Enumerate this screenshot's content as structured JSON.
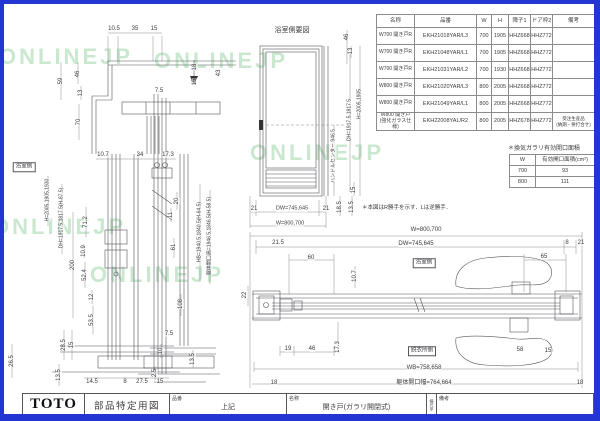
{
  "watermark_text": "ONLINEJP",
  "colors": {
    "frame": "#2336d4",
    "line": "#55565a",
    "dim": "#3c3c40",
    "watermark": "#96d2a0"
  },
  "watermarks": [
    {
      "x": -5,
      "y": 40
    },
    {
      "x": 150,
      "y": 44
    },
    {
      "x": -12,
      "y": 210
    },
    {
      "x": 86,
      "y": 258
    },
    {
      "x": 246,
      "y": 136
    }
  ],
  "parts_table": {
    "headers": [
      "名称",
      "品番",
      "W",
      "H",
      "障子1",
      "ドア枠2",
      "備考"
    ],
    "rows": [
      [
        "W700 開き戸R",
        "EKH21018YAR/L3",
        "700",
        "1905",
        "HHZ668",
        "HHZ772",
        ""
      ],
      [
        "W700 開き戸R",
        "EKH21048YAR/L1",
        "700",
        "1905",
        "HHZ668",
        "HHZ772",
        ""
      ],
      [
        "W700 開き戸R",
        "EKH21031YAR/L2",
        "700",
        "1930",
        "HHZ668",
        "HHZ772",
        ""
      ],
      [
        "W800 開き戸R",
        "EKH21020YAR/L3",
        "800",
        "2005",
        "HHZ668",
        "HHZ772",
        ""
      ],
      [
        "W800 開き戸R",
        "EKH21049YAR/L1",
        "800",
        "2005",
        "HHZ668",
        "HHZ772",
        ""
      ],
      [
        "W800 開き戸\n(強化ガラス仕様)",
        "EKH22008YAL/R2",
        "800",
        "2005",
        "HHZ678",
        "HHZ772",
        "受注生産品\n(納期・要打合せ)"
      ]
    ]
  },
  "vent_table": {
    "title": "＊換気ガラリ有効開口面積",
    "headers": [
      "W",
      "有効開口面積(cm²)"
    ],
    "rows": [
      [
        "700",
        "93"
      ],
      [
        "800",
        "111"
      ]
    ]
  },
  "note": "＊本図はR勝手を示す．Lは逆勝手．",
  "elevation_title": "浴室側要図",
  "boxed_labels": [
    {
      "t": "浴室側",
      "x": 20,
      "y": 163
    },
    {
      "t": "浴室側",
      "x": 420,
      "y": 259
    },
    {
      "t": "脱衣所側",
      "x": 418,
      "y": 347
    }
  ],
  "title_block": {
    "logo": "TOTO",
    "doc_type": "部品特定用図",
    "part_label": "品番",
    "part_value": "上記",
    "name_label": "名称",
    "name_value": "開き戸(ガラリ開閉式)",
    "scale_text": "縮尺非",
    "remarks_label": "備考"
  },
  "labels": [
    {
      "t": "10.5",
      "x": 110,
      "y": 25
    },
    {
      "t": "35",
      "x": 131,
      "y": 25
    },
    {
      "t": "15",
      "x": 150,
      "y": 25
    },
    {
      "t": "59",
      "x": 57,
      "y": 77,
      "v": 1
    },
    {
      "t": "46",
      "x": 74,
      "y": 70,
      "v": 1
    },
    {
      "t": "13",
      "x": 77,
      "y": 89,
      "v": 1
    },
    {
      "t": "70",
      "x": 75,
      "y": 118,
      "v": 1
    },
    {
      "t": "7.5",
      "x": 155,
      "y": 87
    },
    {
      "t": "18",
      "x": 191,
      "y": 63,
      "v": 1
    },
    {
      "t": "15",
      "x": 191,
      "y": 78,
      "v": 1
    },
    {
      "t": "43",
      "x": 215,
      "y": 69,
      "v": 1
    },
    {
      "t": "10.7",
      "x": 99,
      "y": 151
    },
    {
      "t": "34",
      "x": 136,
      "y": 151
    },
    {
      "t": "17.3",
      "x": 164,
      "y": 151
    },
    {
      "t": "200",
      "x": 69,
      "y": 261,
      "v": 1
    },
    {
      "t": "71.2",
      "x": 82,
      "y": 218,
      "v": 1
    },
    {
      "t": "10.9",
      "x": 80,
      "y": 247,
      "v": 1
    },
    {
      "t": "52.4",
      "x": 81,
      "y": 271,
      "v": 1
    },
    {
      "t": "12",
      "x": 88,
      "y": 293,
      "v": 1
    },
    {
      "t": "53.5",
      "x": 88,
      "y": 316,
      "v": 1
    },
    {
      "t": "28.5",
      "x": 60,
      "y": 341,
      "v": 1
    },
    {
      "t": "15",
      "x": 68,
      "y": 341,
      "v": 1
    },
    {
      "t": "13.5",
      "x": 55,
      "y": 371,
      "v": 1
    },
    {
      "t": "26.5",
      "x": 8,
      "y": 357,
      "v": 1
    },
    {
      "t": "14.5",
      "x": 88,
      "y": 378
    },
    {
      "t": "8",
      "x": 121,
      "y": 378
    },
    {
      "t": "27.5",
      "x": 138,
      "y": 378
    },
    {
      "t": "15",
      "x": 156,
      "y": 378
    },
    {
      "t": "20",
      "x": 173,
      "y": 197,
      "v": 1
    },
    {
      "t": "11",
      "x": 167,
      "y": 211,
      "v": 1
    },
    {
      "t": "61",
      "x": 170,
      "y": 243,
      "v": 1
    },
    {
      "t": "108",
      "x": 177,
      "y": 300,
      "v": 1
    },
    {
      "t": "7.5",
      "x": 165,
      "y": 330
    },
    {
      "t": "10",
      "x": 157,
      "y": 347,
      "v": 1
    },
    {
      "t": "2.5",
      "x": 151,
      "y": 369,
      "v": 1
    },
    {
      "t": "13.5",
      "x": 189,
      "y": 355,
      "v": 1
    },
    {
      "t": "HB=1940.5,1840.5(H-64.5)",
      "x": 196,
      "y": 228,
      "v": 1,
      "s": 5
    },
    {
      "t": "躯体開口高=1946.5,1846.5(H-58.5)",
      "x": 206,
      "y": 232,
      "v": 1,
      "s": 5
    },
    {
      "t": "H=2005,1905,1930",
      "x": 44,
      "y": 196,
      "v": 1,
      "s": 5
    },
    {
      "t": "DH=1917.5,1817.5(H-87.5)",
      "x": 58,
      "y": 214,
      "v": 1,
      "s": 5
    },
    {
      "t": "46",
      "x": 343,
      "y": 33,
      "v": 1
    },
    {
      "t": "13",
      "x": 347,
      "y": 47,
      "v": 1
    },
    {
      "t": "H=2005,1905",
      "x": 356,
      "y": 100,
      "v": 1,
      "s": 5
    },
    {
      "t": "DH=1917.5,1817.5",
      "x": 346,
      "y": 116,
      "v": 1,
      "s": 5
    },
    {
      "t": "ハンドルセンター 946.5",
      "x": 330,
      "y": 152,
      "v": 1,
      "s": 5
    },
    {
      "t": "15",
      "x": 350,
      "y": 186,
      "v": 1
    },
    {
      "t": "18.5",
      "x": 336,
      "y": 203,
      "v": 1
    },
    {
      "t": "13.5",
      "x": 348,
      "y": 203,
      "v": 1
    },
    {
      "t": "21",
      "x": 250,
      "y": 205
    },
    {
      "t": "DW=745,645",
      "x": 288,
      "y": 205,
      "s": 5.5
    },
    {
      "t": "21",
      "x": 322,
      "y": 205
    },
    {
      "t": "W=800,700",
      "x": 286,
      "y": 220,
      "s": 5.5
    },
    {
      "t": "W=800,700",
      "x": 422,
      "y": 226
    },
    {
      "t": "DW=745,645",
      "x": 412,
      "y": 240
    },
    {
      "t": "21.5",
      "x": 274,
      "y": 239
    },
    {
      "t": "8",
      "x": 563,
      "y": 239
    },
    {
      "t": "21",
      "x": 577,
      "y": 239
    },
    {
      "t": "60",
      "x": 307,
      "y": 254
    },
    {
      "t": "65",
      "x": 540,
      "y": 253
    },
    {
      "t": "10.7",
      "x": 351,
      "y": 272,
      "v": 1
    },
    {
      "t": "22",
      "x": 241,
      "y": 291,
      "v": 1
    },
    {
      "t": "19",
      "x": 284,
      "y": 345
    },
    {
      "t": "46",
      "x": 308,
      "y": 345
    },
    {
      "t": "17.3",
      "x": 334,
      "y": 343,
      "v": 1
    },
    {
      "t": "58",
      "x": 516,
      "y": 346
    },
    {
      "t": "15",
      "x": 544,
      "y": 347
    },
    {
      "t": "WB=758,658",
      "x": 420,
      "y": 364
    },
    {
      "t": "18",
      "x": 270,
      "y": 379
    },
    {
      "t": "躯体開口幅=764,664",
      "x": 420,
      "y": 379
    },
    {
      "t": "18",
      "x": 576,
      "y": 379
    }
  ]
}
